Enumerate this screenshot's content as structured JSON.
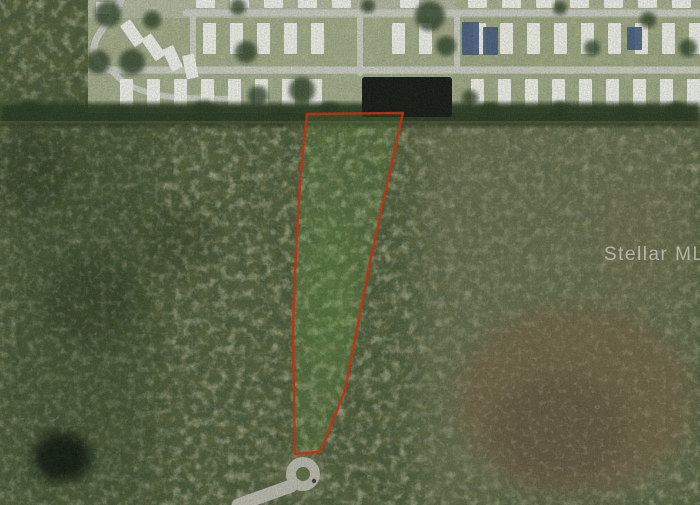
{
  "meta": {
    "description": "Aerial satellite listing photo: vacant wooded parcel outlined in red, bordered by a mobile-home community and pond at top and a cul-de-sac street at bottom"
  },
  "watermark": {
    "text": "Stellar MLS",
    "opacity": 0.5,
    "font_size": 19
  },
  "colors": {
    "forest_base": "#55613c",
    "forest_dark": "#16200f",
    "left_forest_tint": "#394a2b",
    "right_olive_tint": "#75785a",
    "brown_patch": "#6f5e43",
    "brown_patch_dark": "#57493a",
    "brown_streak": "#6d6a4c",
    "dark_blob": "#0d140c",
    "residential_base": "#aeb49d",
    "lawn": "#8e9c6f",
    "street": "#c6cabf",
    "home": "#eef0ea",
    "home_blue": "#44597c",
    "tree": "#2e3f26",
    "treeline": "#2b3b23",
    "dirt_line": "#7a6a4e",
    "pond": "#161c16",
    "parcel_line": "#ce2f10",
    "parcel_fill": "#6fae46",
    "parcel_inner_glow": "#5e9440",
    "culdesac_road": "#b7b8ab",
    "culdesac_halo": "#8d8b72",
    "culdesac_island": "#5f6e48",
    "culdesac_speck": "#3c423a",
    "watermark": "#ffffff"
  },
  "parcel": {
    "outline_points": "307,114 403,113 385,193 368,272 345,390 322,448 318,452 295,454 293,330 295,272 300,180",
    "stroke_width": 2.4
  },
  "pond": {
    "x": 362,
    "y": 77,
    "width": 90,
    "height": 40
  },
  "culdesac": {
    "cx": 303,
    "cy": 474,
    "outer_r": 17,
    "island_r": 7,
    "road_path": "M291,486 C272,493 254,499 238,505"
  },
  "scene": {
    "home_rows": [
      {
        "y": -6,
        "h": 14,
        "w": 19,
        "x0": 196,
        "x1": 692,
        "step": 34,
        "skips": [
          [
            352,
            372
          ],
          [
            448,
            464
          ]
        ]
      },
      {
        "y": 23,
        "h": 31,
        "w": 13,
        "x0": 203,
        "x1": 690,
        "step": 27,
        "skips": [
          [
            350,
            372
          ],
          [
            446,
            466
          ]
        ]
      },
      {
        "y": 79,
        "h": 28,
        "w": 13,
        "x0": 120,
        "x1": 690,
        "step": 27,
        "skips": [
          [
            346,
            468
          ]
        ]
      }
    ],
    "blue_homes": [
      {
        "x": 462,
        "y": 22,
        "w": 17,
        "h": 33
      },
      {
        "x": 483,
        "y": 27,
        "w": 15,
        "h": 28
      },
      {
        "x": 627,
        "y": 27,
        "w": 15,
        "h": 23
      }
    ],
    "angled_homes": [
      {
        "x": 96,
        "y": 2,
        "w": 16,
        "h": 12,
        "a": 0
      },
      {
        "x": 120,
        "y": 26,
        "w": 12,
        "h": 26,
        "a": -35
      },
      {
        "x": 141,
        "y": 40,
        "w": 12,
        "h": 26,
        "a": -35
      },
      {
        "x": 162,
        "y": 50,
        "w": 12,
        "h": 24,
        "a": -25
      },
      {
        "x": 182,
        "y": 56,
        "w": 12,
        "h": 24,
        "a": -12
      }
    ],
    "trees": [
      {
        "x": 108,
        "y": 14,
        "r": 13
      },
      {
        "x": 98,
        "y": 62,
        "r": 12
      },
      {
        "x": 132,
        "y": 62,
        "r": 13
      },
      {
        "x": 152,
        "y": 20,
        "r": 9
      },
      {
        "x": 238,
        "y": 7,
        "r": 8
      },
      {
        "x": 246,
        "y": 52,
        "r": 11
      },
      {
        "x": 258,
        "y": 96,
        "r": 10
      },
      {
        "x": 302,
        "y": 90,
        "r": 13
      },
      {
        "x": 368,
        "y": 6,
        "r": 7
      },
      {
        "x": 430,
        "y": 16,
        "r": 15
      },
      {
        "x": 446,
        "y": 46,
        "r": 10
      },
      {
        "x": 470,
        "y": 98,
        "r": 8
      },
      {
        "x": 560,
        "y": 8,
        "r": 7
      },
      {
        "x": 592,
        "y": 48,
        "r": 8
      },
      {
        "x": 648,
        "y": 20,
        "r": 8
      },
      {
        "x": 688,
        "y": 48,
        "r": 9
      }
    ],
    "treeline_blobs": [
      {
        "x": 30,
        "y": 112,
        "r": 11
      },
      {
        "x": 120,
        "y": 116,
        "r": 10
      },
      {
        "x": 205,
        "y": 112,
        "r": 12
      },
      {
        "x": 280,
        "y": 117,
        "r": 9
      },
      {
        "x": 330,
        "y": 112,
        "r": 10
      },
      {
        "x": 490,
        "y": 114,
        "r": 11
      },
      {
        "x": 560,
        "y": 110,
        "r": 9
      },
      {
        "x": 628,
        "y": 115,
        "r": 10
      },
      {
        "x": 676,
        "y": 111,
        "r": 9
      }
    ]
  }
}
